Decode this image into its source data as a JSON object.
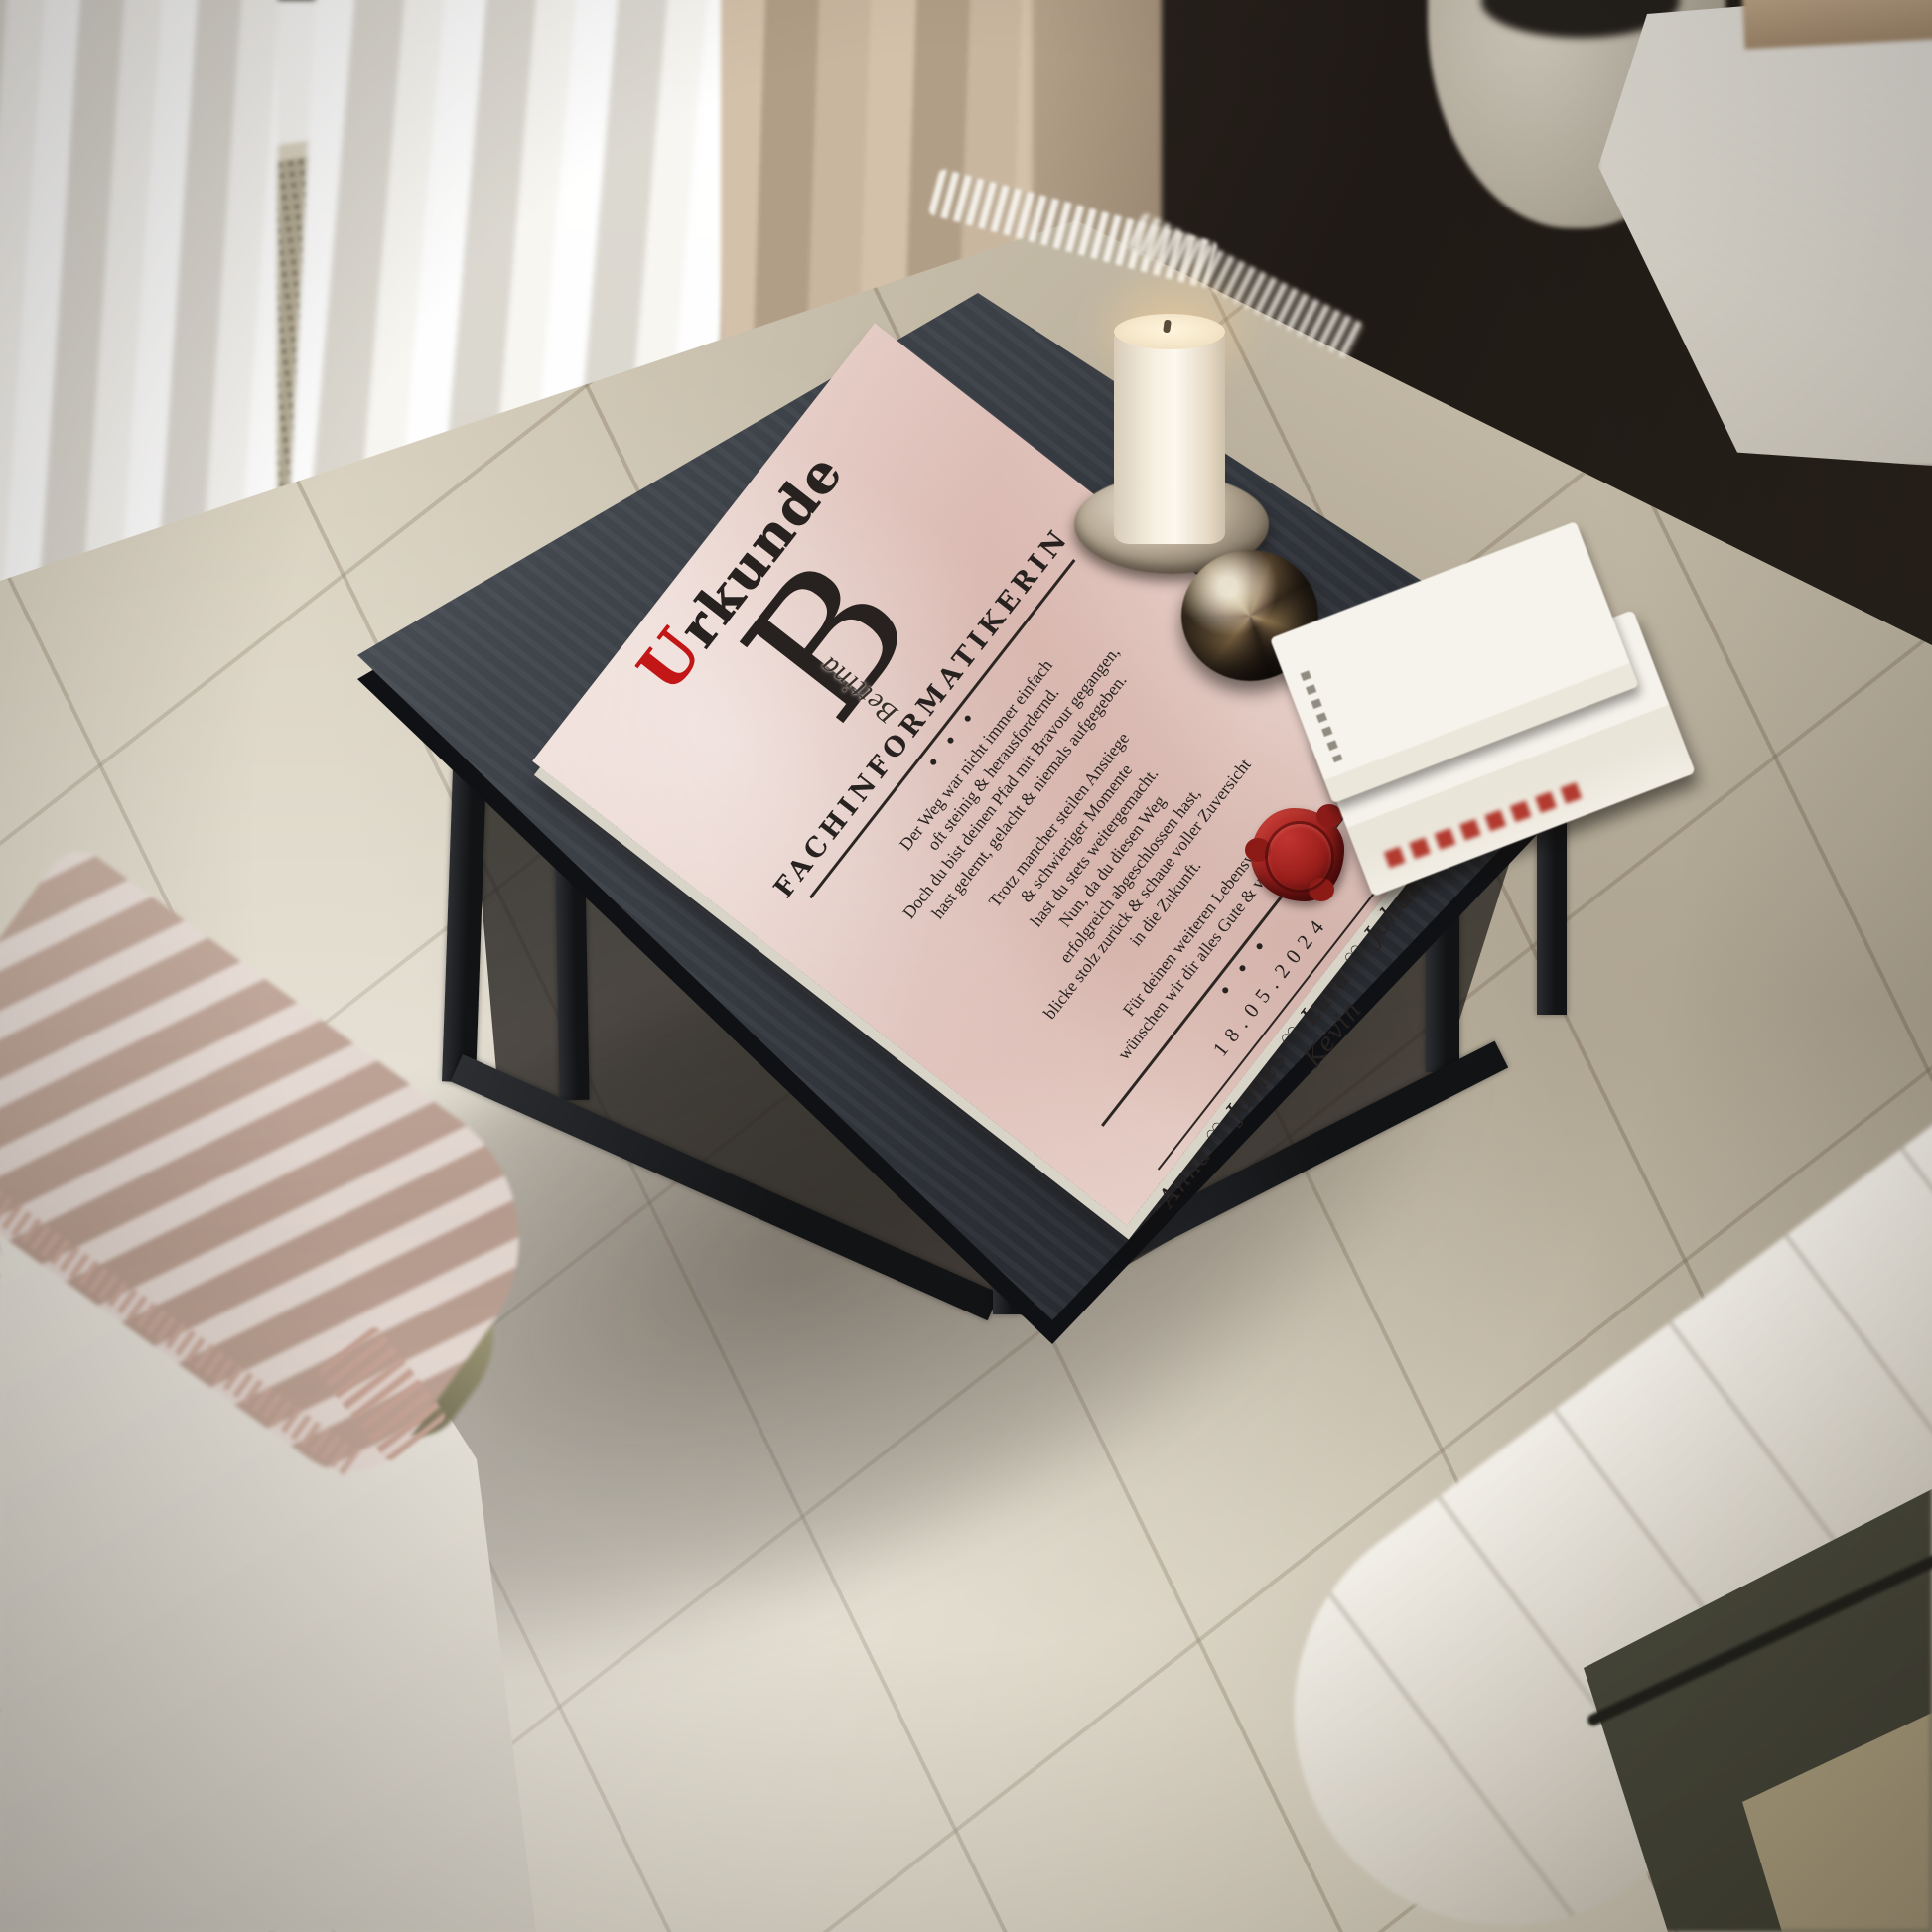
{
  "certificate": {
    "title_initial": "U",
    "title_rest": "rkunde",
    "monogram_letter": "B",
    "monogram_name": "Bettina",
    "profession": "FACHINFORMATIKERIN",
    "separator_dots": "● ● ●",
    "paragraphs": [
      "Der Weg war nicht immer einfach\noft steinig & herausfordernd.\nDoch du bist deinen Pfad mit Bravour gegangen,\nhast gelernt, gelacht & niemals aufgegeben.",
      "Trotz mancher steilen Anstiege\n& schwieriger Momente\nhast du stets weitergemacht.\nNun, da du diesen Weg\nerfolgreich abgeschlossen hast,\nblicke stolz zurück & schaue voller Zuversicht\nin die Zukunft.",
      "Für deinen weiteren Lebensweg\nwünschen wir dir alles Gute & viel Erfolg!"
    ],
    "date": "18.05.2024",
    "names": "Anna ♡ James ♡ Lara ♡ Johanna ♡ Kevin"
  },
  "colors": {
    "accent_red": "#c31616",
    "wax_seal_red": "#8f1d1b",
    "parchment_pink": "#e6cdc6",
    "table_top_charcoal": "#3c4046",
    "rug_cream": "#d7cfbc"
  }
}
